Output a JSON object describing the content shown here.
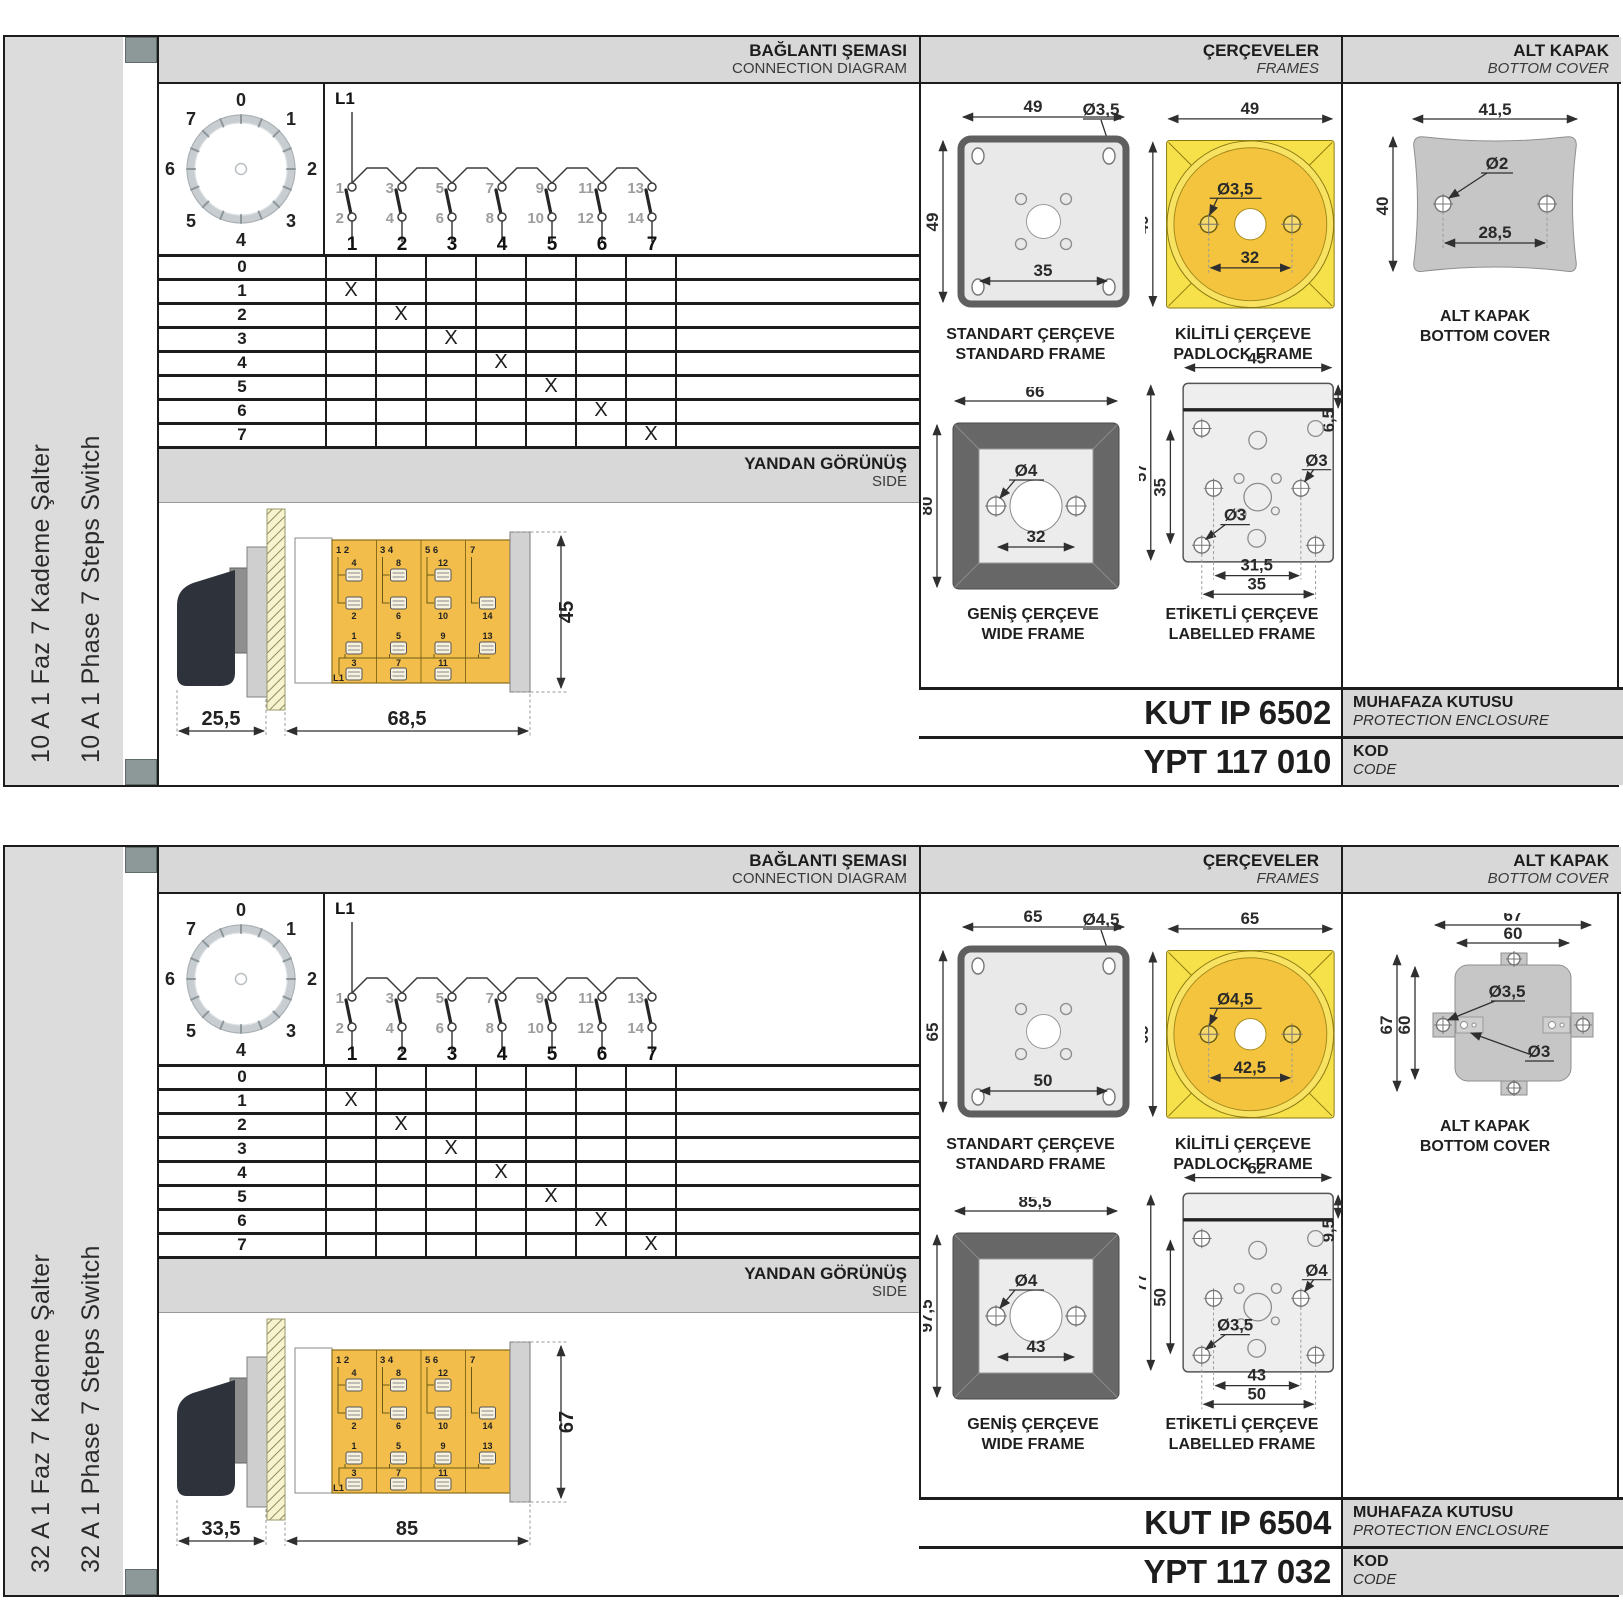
{
  "page": {
    "background": "#ffffff"
  },
  "colors": {
    "accent_yellow": "#f3c53e",
    "bright_yellow": "#f6e14b",
    "panel_grey": "#d8d8d8",
    "sidebar_grey": "#dcdcdc",
    "cover_grey": "#c6c6c6",
    "line_dark": "#1c1c1c"
  },
  "dial": {
    "positions": [
      "0",
      "1",
      "2",
      "3",
      "4",
      "5",
      "6",
      "7"
    ]
  },
  "schematic": {
    "line_label": "L1",
    "top_terminals": [
      "1",
      "3",
      "5",
      "7",
      "9",
      "11",
      "13"
    ],
    "bottom_terminals": [
      "2",
      "4",
      "6",
      "8",
      "10",
      "12",
      "14"
    ],
    "pole_numbers": [
      "1",
      "2",
      "3",
      "4",
      "5",
      "6",
      "7"
    ]
  },
  "steps_table": {
    "rows": [
      {
        "label": "0",
        "marks": [
          "",
          "",
          "",
          "",
          "",
          "",
          ""
        ]
      },
      {
        "label": "1",
        "marks": [
          "X",
          "",
          "",
          "",
          "",
          "",
          ""
        ]
      },
      {
        "label": "2",
        "marks": [
          "",
          "X",
          "",
          "",
          "",
          "",
          ""
        ]
      },
      {
        "label": "3",
        "marks": [
          "",
          "",
          "X",
          "",
          "",
          "",
          ""
        ]
      },
      {
        "label": "4",
        "marks": [
          "",
          "",
          "",
          "X",
          "",
          "",
          ""
        ]
      },
      {
        "label": "5",
        "marks": [
          "",
          "",
          "",
          "",
          "X",
          "",
          ""
        ]
      },
      {
        "label": "6",
        "marks": [
          "",
          "",
          "",
          "",
          "",
          "X",
          ""
        ]
      },
      {
        "label": "7",
        "marks": [
          "",
          "",
          "",
          "",
          "",
          "",
          "X"
        ]
      }
    ]
  },
  "side_view": {
    "corner_labels": [
      "1 2",
      "3 4",
      "5 6",
      "7"
    ],
    "row1_upper": [
      "4",
      "8",
      "12"
    ],
    "row1_lower": [
      "2",
      "6",
      "10",
      "14"
    ],
    "row2_upper": [
      "1",
      "5",
      "9",
      "13"
    ],
    "row2_lower": [
      "3",
      "7",
      "11"
    ],
    "line_label": "L1"
  },
  "sections": [
    {
      "sidebar": {
        "title_tr": "10 A 1 Faz 7 Kademe Şalter",
        "title_en": "10 A 1 Phase 7 Steps Switch"
      },
      "headers": {
        "connection_tr": "BAĞLANTI ŞEMASI",
        "connection_en": "CONNECTION DIAGRAM",
        "frames_tr": "ÇERÇEVELER",
        "frames_en": "FRAMES",
        "cover_tr": "ALT KAPAK",
        "cover_en": "BOTTOM COVER",
        "side_tr": "YANDAN GÖRÜNÜŞ",
        "side_en": "SIDE"
      },
      "side_dims": {
        "handle": "25,5",
        "body": "68,5",
        "height": "45"
      },
      "frames": {
        "standard": {
          "caption_tr": "STANDART ÇERÇEVE",
          "caption_en": "STANDARD FRAME",
          "width": "49",
          "height": "49",
          "hole": "Ø3,5",
          "inner": "35"
        },
        "padlock": {
          "caption_tr": "KİLİTLİ ÇERÇEVE",
          "caption_en": "PADLOCK FRAME",
          "width": "49",
          "height": "49",
          "hole": "Ø3,5",
          "inner": "32"
        },
        "wide": {
          "caption_tr": "GENİŞ ÇERÇEVE",
          "caption_en": "WIDE FRAME",
          "width": "66",
          "height": "80",
          "hole": "Ø4",
          "inner": "32"
        },
        "labelled": {
          "caption_tr": "ETİKETLİ ÇERÇEVE",
          "caption_en": "LABELLED FRAME",
          "width": "45",
          "strip": "6,5",
          "height": "57",
          "inner_height": "35",
          "hole_upper": "Ø3",
          "hole_lower": "Ø3",
          "inner_width": "31,5",
          "outer_width": "35"
        }
      },
      "cover": {
        "caption_tr": "ALT KAPAK",
        "caption_en": "BOTTOM COVER",
        "width": "41,5",
        "height": "40",
        "hole": "Ø2",
        "inner": "28,5"
      },
      "codes": {
        "enclosure_code": "KUT IP 6502",
        "enclosure_label_tr": "MUHAFAZA KUTUSU",
        "enclosure_label_en": "PROTECTION ENCLOSURE",
        "code": "YPT 117 010",
        "code_label_tr": "KOD",
        "code_label_en": "CODE"
      }
    },
    {
      "sidebar": {
        "title_tr": "32 A 1 Faz 7 Kademe Şalter",
        "title_en": "32 A 1 Phase 7 Steps Switch"
      },
      "headers": {
        "connection_tr": "BAĞLANTI ŞEMASI",
        "connection_en": "CONNECTION DIAGRAM",
        "frames_tr": "ÇERÇEVELER",
        "frames_en": "FRAMES",
        "cover_tr": "ALT KAPAK",
        "cover_en": "BOTTOM COVER",
        "side_tr": "YANDAN GÖRÜNÜŞ",
        "side_en": "SIDE"
      },
      "side_dims": {
        "handle": "33,5",
        "body": "85",
        "height": "67"
      },
      "frames": {
        "standard": {
          "caption_tr": "STANDART ÇERÇEVE",
          "caption_en": "STANDARD FRAME",
          "width": "65",
          "height": "65",
          "hole": "Ø4,5",
          "inner": "50"
        },
        "padlock": {
          "caption_tr": "KİLİTLİ ÇERÇEVE",
          "caption_en": "PADLOCK FRAME",
          "width": "65",
          "height": "65",
          "hole": "Ø4,5",
          "inner": "42,5"
        },
        "wide": {
          "caption_tr": "GENİŞ ÇERÇEVE",
          "caption_en": "WIDE FRAME",
          "width": "85,5",
          "height": "97,5",
          "hole": "Ø4",
          "inner": "43"
        },
        "labelled": {
          "caption_tr": "ETİKETLİ ÇERÇEVE",
          "caption_en": "LABELLED FRAME",
          "width": "62",
          "strip": "9,5",
          "height": "77",
          "inner_height": "50",
          "hole_upper": "Ø4",
          "hole_lower": "Ø3,5",
          "inner_width": "43",
          "outer_width": "50"
        }
      },
      "cover": {
        "caption_tr": "ALT KAPAK",
        "caption_en": "BOTTOM COVER",
        "outer_width": "67",
        "inner_width": "60",
        "outer_height": "67",
        "inner_height": "60",
        "hole": "Ø3,5",
        "hole_small": "Ø3"
      },
      "codes": {
        "enclosure_code": "KUT IP 6504",
        "enclosure_label_tr": "MUHAFAZA KUTUSU",
        "enclosure_label_en": "PROTECTION ENCLOSURE",
        "code": "YPT 117 032",
        "code_label_tr": "KOD",
        "code_label_en": "CODE"
      }
    }
  ]
}
